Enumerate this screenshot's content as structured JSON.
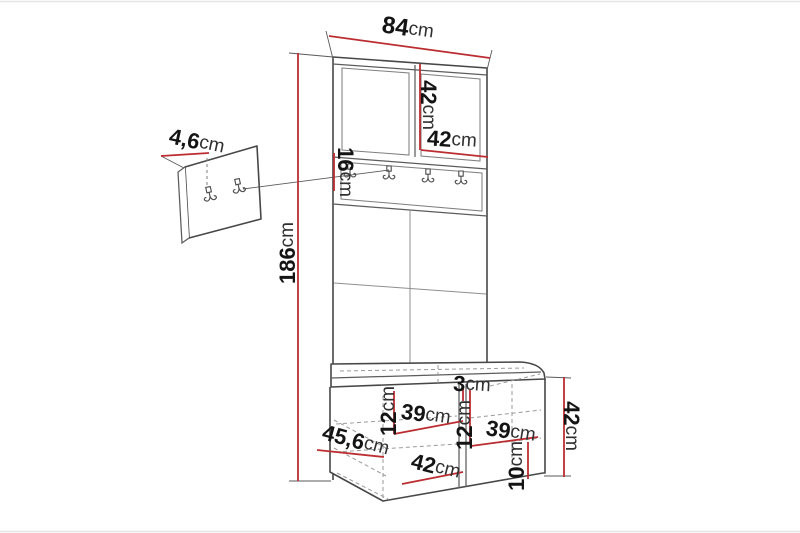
{
  "colors": {
    "dimension_red": "#bb2d31",
    "outline_dark": "#474747",
    "outline_light": "#8a8a8a",
    "background": "#ffffff"
  },
  "diagram": {
    "type": "furniture-dimension-drawing",
    "subject": "hallway wardrobe with coat hook rail and shoe bench, plus detached wall hook panel",
    "wall_panel": {
      "hook_count": 2
    },
    "hook_rail": {
      "hook_count": 4
    },
    "dimensions": [
      {
        "id": "total-width",
        "value": "84",
        "unit": "cm"
      },
      {
        "id": "top-door-height",
        "value": "42",
        "unit": "cm"
      },
      {
        "id": "top-door-width",
        "value": "42",
        "unit": "cm"
      },
      {
        "id": "wall-panel-thickness",
        "value": "4,6",
        "unit": "cm"
      },
      {
        "id": "hook-rail-height",
        "value": "16",
        "unit": "cm"
      },
      {
        "id": "total-height",
        "value": "186",
        "unit": "cm"
      },
      {
        "id": "seat-pad-thickness",
        "value": "3",
        "unit": "cm"
      },
      {
        "id": "bench-left-compartment-height",
        "value": "12",
        "unit": "cm"
      },
      {
        "id": "bench-left-compartment-width",
        "value": "39",
        "unit": "cm"
      },
      {
        "id": "bench-depth",
        "value": "45,6",
        "unit": "cm"
      },
      {
        "id": "bench-door-width",
        "value": "42",
        "unit": "cm"
      },
      {
        "id": "bench-middle-compartment-height",
        "value": "12",
        "unit": "cm"
      },
      {
        "id": "bench-right-compartment-width",
        "value": "39",
        "unit": "cm"
      },
      {
        "id": "bench-plinth-height",
        "value": "10",
        "unit": "cm"
      },
      {
        "id": "bench-height",
        "value": "42",
        "unit": "cm"
      }
    ]
  }
}
